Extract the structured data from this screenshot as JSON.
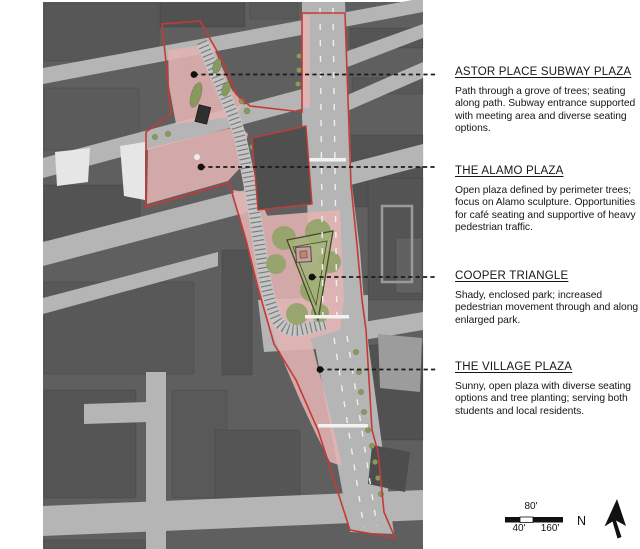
{
  "annotations": [
    {
      "heading": "ASTOR PLACE SUBWAY PLAZA",
      "body": "Path through a grove of trees; seating along path.  Subway entrance supported with meeting area and diverse seating options."
    },
    {
      "heading": "THE ALAMO PLAZA",
      "body": "Open plaza defined by perimeter trees; focus on Alamo sculpture. Opportunities  for café seating and supportive of heavy pedestrian traffic."
    },
    {
      "heading": "COOPER TRIANGLE",
      "body": "Shady, enclosed park; increased pedestrian movement through and along enlarged park."
    },
    {
      "heading": "THE VILLAGE PLAZA",
      "body": "Sunny, open plaza with diverse seating options and tree planting; serving both students and local residents."
    }
  ],
  "scale_bar": {
    "top_label": "80'",
    "left_label": "40'",
    "right_label": "160'"
  },
  "compass": {
    "label": "N"
  },
  "map": {
    "highlighted_areas": [
      "Astor Place Subway Plaza",
      "The Alamo Plaza",
      "Cooper Triangle",
      "The Village Plaza"
    ],
    "colors": {
      "highlight_outline": "#c43b36",
      "highlight_fill": "#e5b3b3",
      "park": "#9cab72",
      "street": "#b5b5b5",
      "building": "#5a5a5a"
    }
  }
}
